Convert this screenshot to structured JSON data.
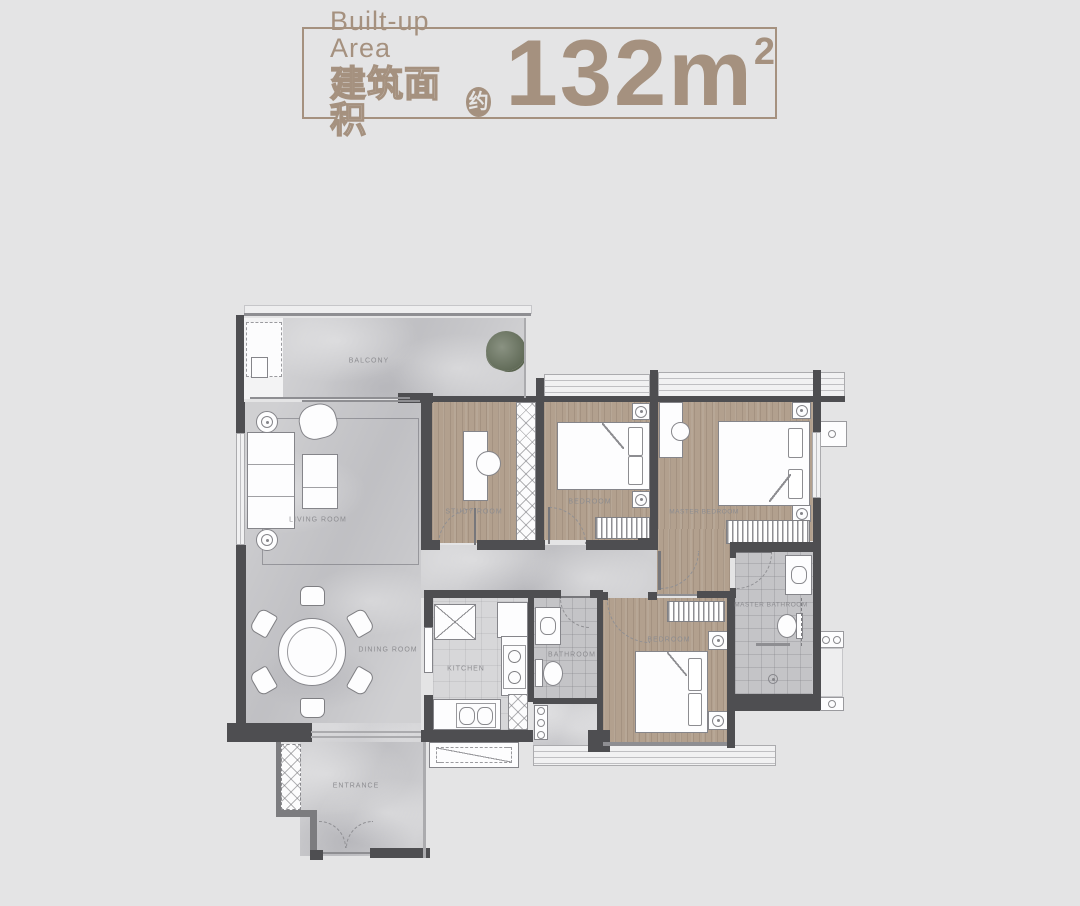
{
  "header": {
    "title_en": "Built-up Area",
    "title_zh": "建筑面积",
    "approx_badge": "约",
    "area_number": "132m",
    "area_exponent": "2"
  },
  "floorplan": {
    "rooms": [
      {
        "key": "balcony",
        "label": "BALCONY"
      },
      {
        "key": "living-room",
        "label": "LIVING ROOM"
      },
      {
        "key": "dining-room",
        "label": "DINING ROOM"
      },
      {
        "key": "entrance",
        "label": "ENTRANCE"
      },
      {
        "key": "study-room",
        "label": "STUDY ROOM"
      },
      {
        "key": "bedroom-top",
        "label": "BEDROOM"
      },
      {
        "key": "master-bedroom",
        "label": "MASTER BEDROOM"
      },
      {
        "key": "kitchen",
        "label": "KITCHEN"
      },
      {
        "key": "bathroom",
        "label": "BATHROOM"
      },
      {
        "key": "bedroom-bottom",
        "label": "BEDROOM"
      },
      {
        "key": "master-bathroom",
        "label": "MASTER BATHROOM"
      }
    ],
    "colors": {
      "accent": "#a5917f",
      "wall": "#4e4e51",
      "wood_floor": "#b2a08e",
      "marble_floor": "#c7c7ca",
      "tile_floor": "#c4c4c7",
      "background": "#e4e4e5"
    }
  }
}
